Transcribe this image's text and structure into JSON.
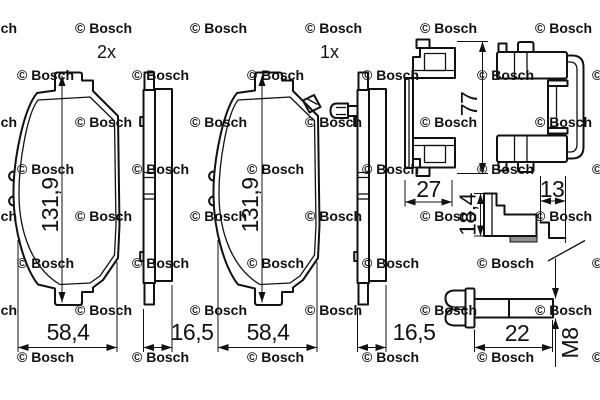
{
  "drawing": {
    "type": "brake-pad-set-technical-drawing",
    "background": "#ffffff",
    "line_color": "#111111",
    "pad_shim_color": "#8f8f8f",
    "quantities": {
      "left_pad": "2x",
      "right_pad": "1x"
    },
    "dimensions": {
      "pad_height": "131,9",
      "pad_width": "58,4",
      "pad_thickness": "16,5",
      "clip_profile_width": "27",
      "clip_height": "77",
      "spring_clip_height": "18,4",
      "spring_clip_width": "13",
      "bolt_shank_length": "22",
      "bolt_thread": "M8"
    },
    "watermark": {
      "text": "© Bosch",
      "color": "#c6c6c6"
    }
  }
}
